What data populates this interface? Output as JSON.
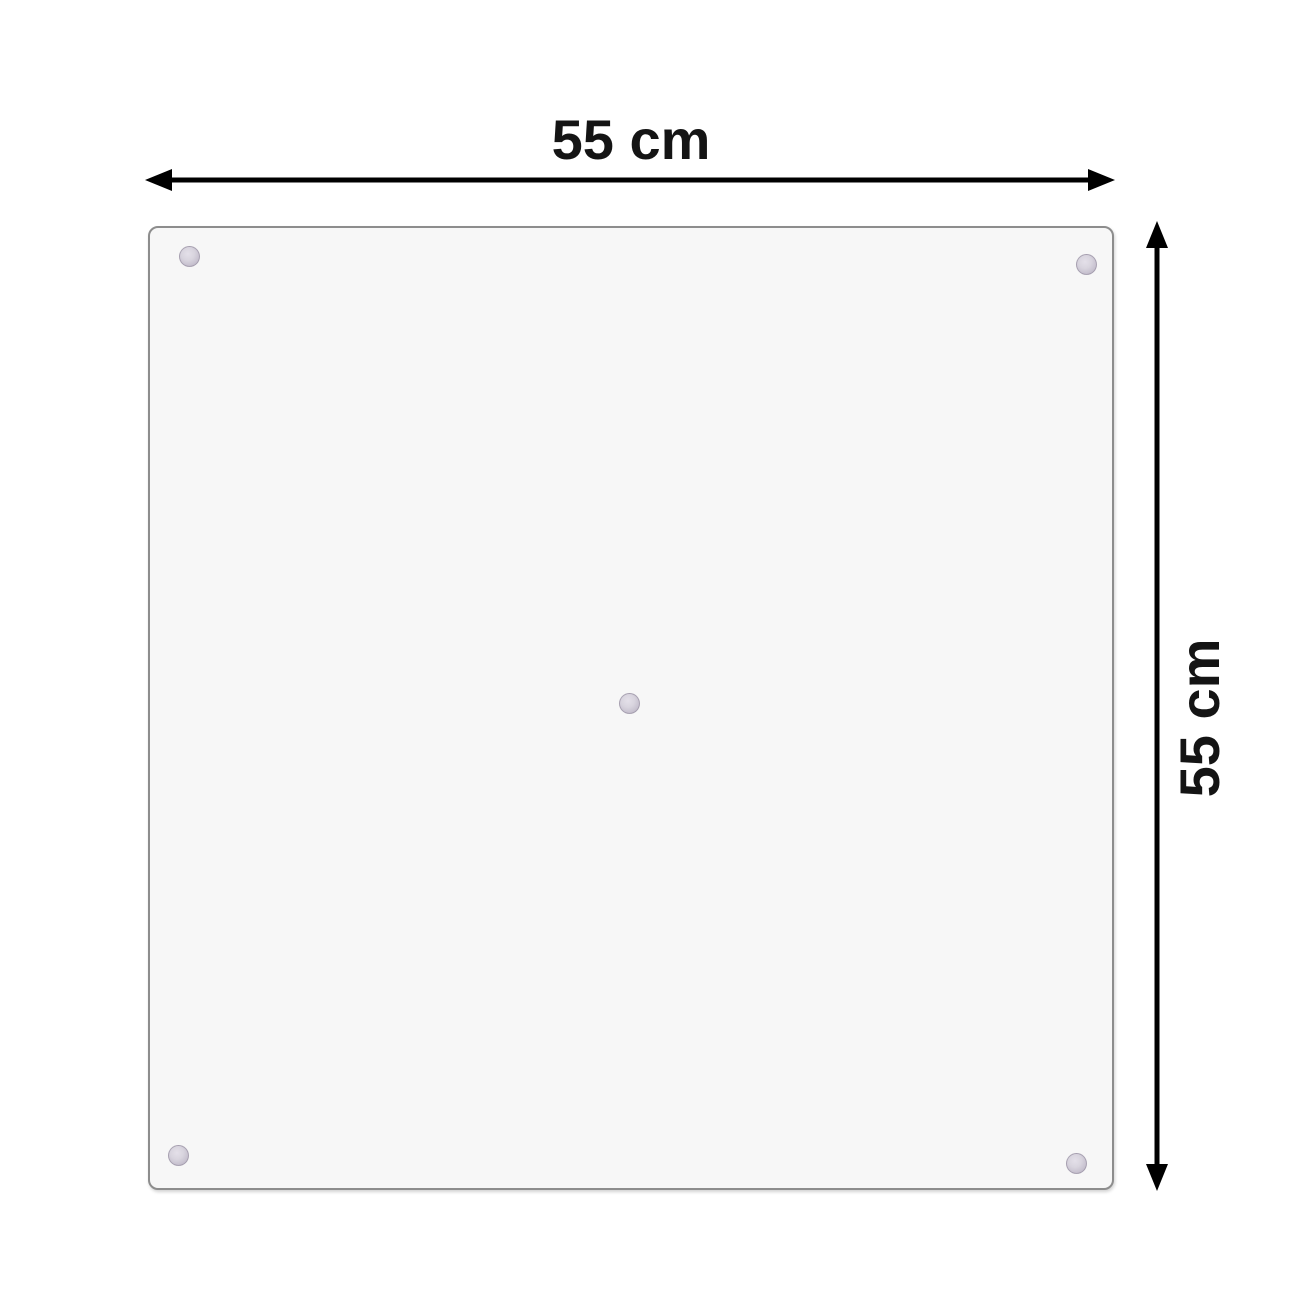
{
  "diagram": {
    "type": "product-dimension-diagram",
    "background_color": "#ffffff",
    "labels": {
      "width": "55 cm",
      "height": "55 cm"
    },
    "arrow_color": "#000000",
    "panel": {
      "fill_color": "#f7f7f7",
      "border_color": "#8d8d8d",
      "corner_radius_px": 10,
      "suction_cup_count": 5,
      "suction_cup_color": "#c6c0ce",
      "suction_cup_positions": [
        "top-left",
        "top-right",
        "center",
        "bottom-left",
        "bottom-right"
      ]
    }
  }
}
